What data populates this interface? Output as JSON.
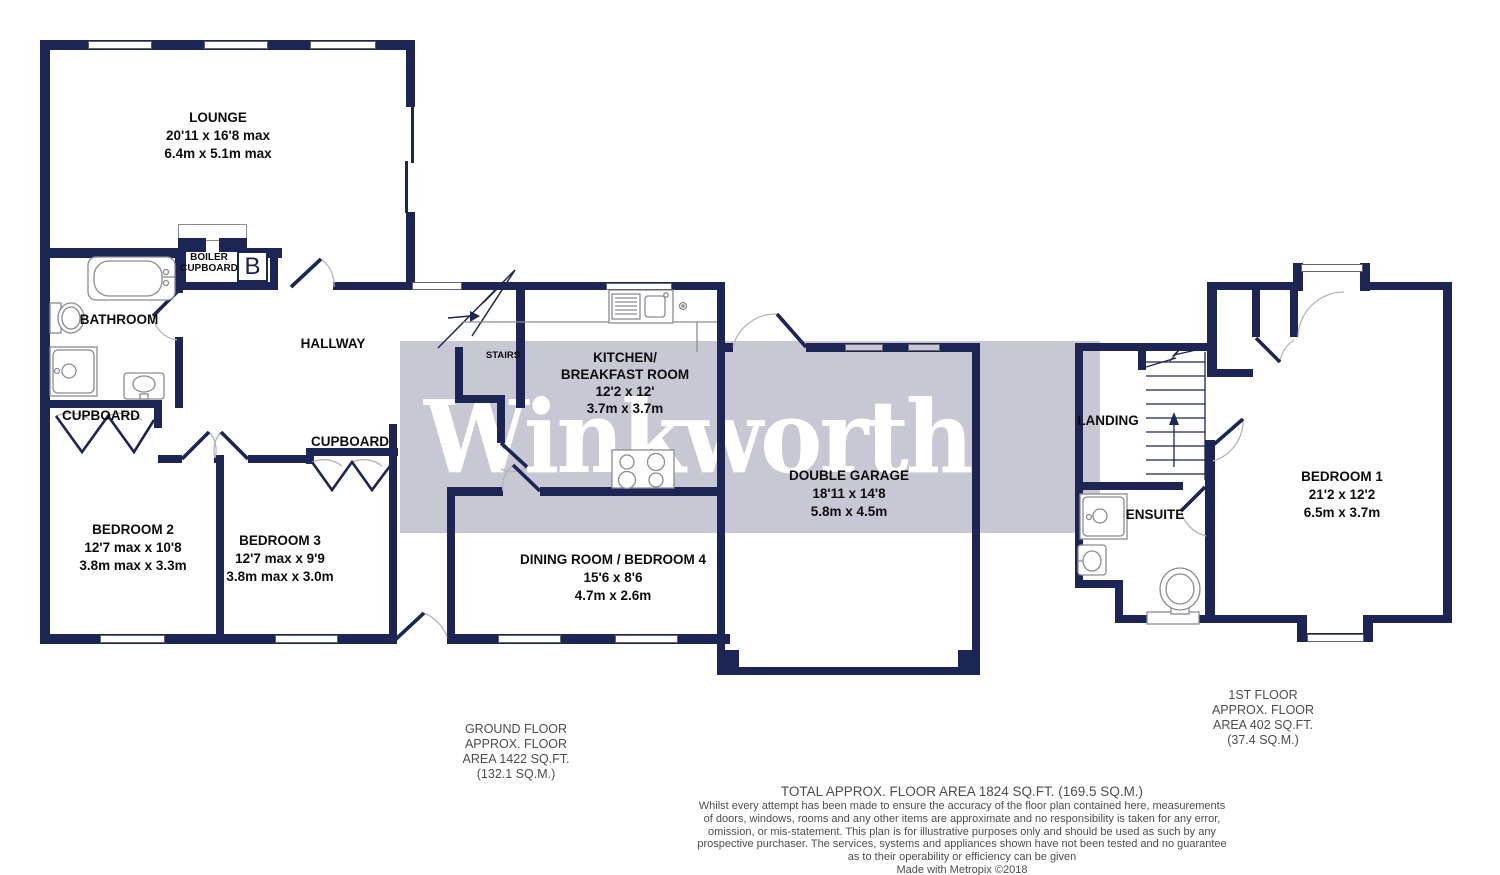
{
  "watermark": "Winkworth",
  "colors": {
    "wall": "#1c2553",
    "band": "#c8c8d4"
  },
  "rooms": {
    "lounge": {
      "name": "LOUNGE",
      "dims1": "20'11 x 16'8 max",
      "dims2": "6.4m x 5.1m max"
    },
    "kitchen": {
      "name1": "KITCHEN/",
      "name2": "BREAKFAST ROOM",
      "dims1": "12'2 x 12'",
      "dims2": "3.7m x 3.7m"
    },
    "garage": {
      "name": "DOUBLE GARAGE",
      "dims1": "18'11 x 14'8",
      "dims2": "5.8m x 4.5m"
    },
    "dining": {
      "name": "DINING ROOM / BEDROOM 4",
      "dims1": "15'6 x 8'6",
      "dims2": "4.7m x 2.6m"
    },
    "bedroom1": {
      "name": "BEDROOM 1",
      "dims1": "21'2 x 12'2",
      "dims2": "6.5m x 3.7m"
    },
    "bedroom2": {
      "name": "BEDROOM 2",
      "dims1": "12'7 max x 10'8",
      "dims2": "3.8m max x 3.3m"
    },
    "bedroom3": {
      "name": "BEDROOM 3",
      "dims1": "12'7 max x 9'9",
      "dims2": "3.8m max x 3.0m"
    }
  },
  "labels": {
    "bathroom": "BATHROOM",
    "hallway": "HALLWAY",
    "stairs": "STAIRS",
    "landing": "LANDING",
    "ensuite": "ENSUITE",
    "cupboard_left": "CUPBOARD",
    "cupboard_bedroom3": "CUPBOARD",
    "boiler1": "BOILER",
    "boiler2": "CUPBOARD",
    "boiler_symbol": "B"
  },
  "footer": {
    "ground_floor_lines": [
      "GROUND FLOOR",
      "APPROX. FLOOR",
      "AREA 1422 SQ.FT.",
      "(132.1 SQ.M.)"
    ],
    "first_floor_lines": [
      "1ST FLOOR",
      "APPROX. FLOOR",
      "AREA 402 SQ.FT.",
      "(37.4 SQ.M.)"
    ],
    "total": "TOTAL APPROX. FLOOR AREA 1824 SQ.FT. (169.5 SQ.M.)",
    "disclaimer_lines": [
      "Whilst every attempt has been made to ensure the accuracy of the floor plan contained here, measurements",
      "of doors, windows, rooms and any other items are approximate and no responsibility is taken for any error,",
      "omission, or mis-statement. This plan is for illustrative purposes only and should be used as such by any",
      "prospective purchaser. The services, systems and appliances shown have not been tested and no guarantee",
      "as to their operability or efficiency can be given",
      "Made with Metropix ©2018"
    ]
  }
}
